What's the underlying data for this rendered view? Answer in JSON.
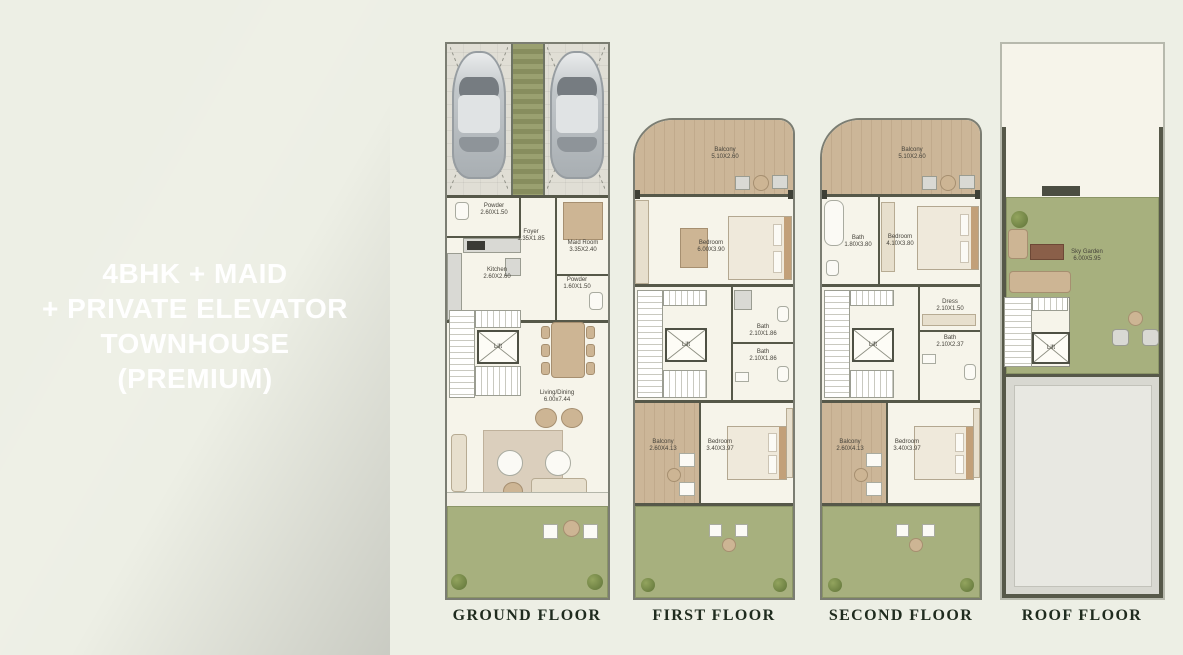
{
  "left_panel": {
    "lines": [
      "4BHK + MAID",
      "+ PRIVATE ELEVATOR",
      "TOWNHOUSE",
      "(PREMIUM)"
    ]
  },
  "colors": {
    "panel_green_dark": "#052a1b",
    "panel_green": "#0b3a27",
    "canvas_background": "#edefe5",
    "plan_floor": "#f6f4ea",
    "wall": "#565849",
    "balcony_wood": "#c8b294",
    "garden_green": "#a7b07e",
    "roof_gray": "#d8d8d1",
    "title_text": "#ffffff",
    "floor_title_text": "#1f2b1e"
  },
  "floors": {
    "ground": {
      "title": "GROUND FLOOR",
      "rooms": {
        "powder1": {
          "name": "Powder",
          "dims": "2.60X1.50"
        },
        "foyer": {
          "name": "Foyer",
          "dims": "1.35X1.85"
        },
        "maid": {
          "name": "Maid Room",
          "dims": "3.35X2.40"
        },
        "kitchen": {
          "name": "Kitchen",
          "dims": "2.60X2.60"
        },
        "powder2": {
          "name": "Powder",
          "dims": "1.60X1.50"
        },
        "lift": {
          "name": "Lift"
        },
        "living": {
          "name": "Living/Dining",
          "dims": "6.00x7.44"
        }
      }
    },
    "first": {
      "title": "FIRST FLOOR",
      "rooms": {
        "balcony_top": {
          "name": "Balcony",
          "dims": "5.10X2.60"
        },
        "bedroom_top": {
          "name": "Bedroom",
          "dims": "6.00X3.90"
        },
        "bath1": {
          "name": "Bath",
          "dims": "2.10X1.86"
        },
        "bath2": {
          "name": "Bath",
          "dims": "2.10X1.86"
        },
        "lift": {
          "name": "Lift"
        },
        "balcony_bottom": {
          "name": "Balcony",
          "dims": "2.60X4.13"
        },
        "bedroom_bottom": {
          "name": "Bedroom",
          "dims": "3.40X3.97"
        }
      }
    },
    "second": {
      "title": "SECOND FLOOR",
      "rooms": {
        "balcony_top": {
          "name": "Balcony",
          "dims": "5.10X2.60"
        },
        "bath_master": {
          "name": "Bath",
          "dims": "1.80X3.80"
        },
        "bedroom_master": {
          "name": "Bedroom",
          "dims": "4.10X3.80"
        },
        "dress": {
          "name": "Dress",
          "dims": "2.10X1.50"
        },
        "bath2": {
          "name": "Bath",
          "dims": "2.10X2.37"
        },
        "lift": {
          "name": "Lift"
        },
        "balcony_bottom": {
          "name": "Balcony",
          "dims": "2.60X4.13"
        },
        "bedroom_bottom": {
          "name": "Bedroom",
          "dims": "3.40X3.97"
        }
      }
    },
    "roof": {
      "title": "ROOF FLOOR",
      "rooms": {
        "sky_garden": {
          "name": "Sky Garden",
          "dims": "6.00X5.95"
        },
        "lift": {
          "name": "Lift"
        }
      }
    }
  }
}
